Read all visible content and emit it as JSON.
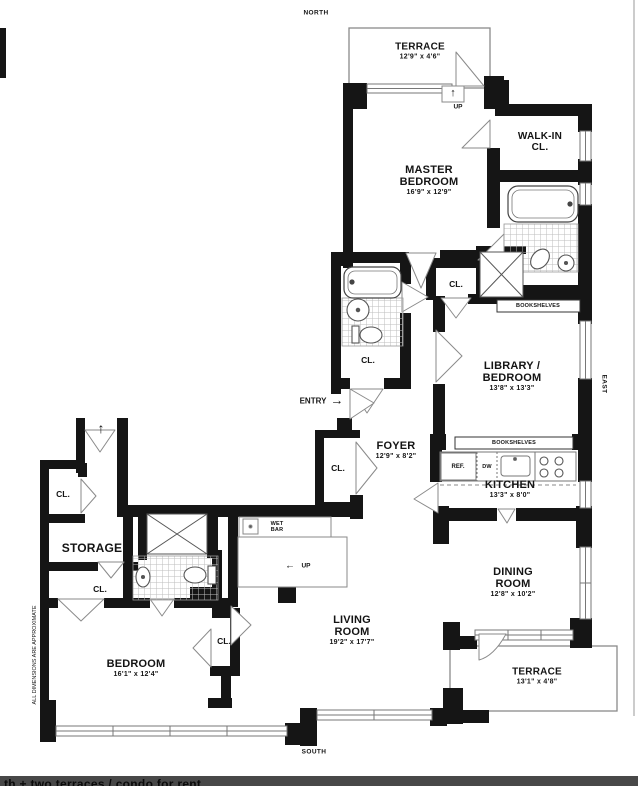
{
  "compass": {
    "north": "NORTH",
    "south": "SOUTH",
    "east": "EAST"
  },
  "note": "ALL DIMENSIONS ARE APPROXIMATE",
  "rooms": {
    "terrace_north": {
      "name": "TERRACE",
      "dims": "12'9\" x 4'6\""
    },
    "master_bedroom": {
      "name": "MASTER BEDROOM",
      "dims": "16'9\" x 12'9\""
    },
    "walk_in_closet": {
      "name": "WALK-IN CL."
    },
    "library_bedroom": {
      "name": "LIBRARY / BEDROOM",
      "dims": "13'8\" x 13'3\""
    },
    "foyer": {
      "name": "FOYER",
      "dims": "12'9\" x 8'2\""
    },
    "kitchen": {
      "name": "KITCHEN",
      "dims": "13'3\" x 8'0\""
    },
    "dining_room": {
      "name": "DINING ROOM",
      "dims": "12'8\" x 10'2\""
    },
    "terrace_south": {
      "name": "TERRACE",
      "dims": "13'1\" x 4'8\""
    },
    "living_room": {
      "name": "LIVING ROOM",
      "dims": "19'2\" x 17'7\""
    },
    "bedroom": {
      "name": "BEDROOM",
      "dims": "16'1\" x 12'4\""
    },
    "storage": {
      "name": "STORAGE"
    },
    "wet_bar": {
      "name": "WET BAR"
    }
  },
  "labels": {
    "closet": "CL.",
    "entry": "ENTRY",
    "up": "UP",
    "bookshelves": "BOOKSHELVES",
    "refrigerator": "REF.",
    "dishwasher": "DW",
    "entry_arrow": "→",
    "up_arrow": "↑",
    "left_arrow": "←"
  },
  "caption": {
    "text": "th + two terraces / condo for rent"
  },
  "colors": {
    "wall": "#151515",
    "thin_line": "#8a8a8a",
    "background": "#ffffff",
    "caption_bar": "#484848"
  }
}
